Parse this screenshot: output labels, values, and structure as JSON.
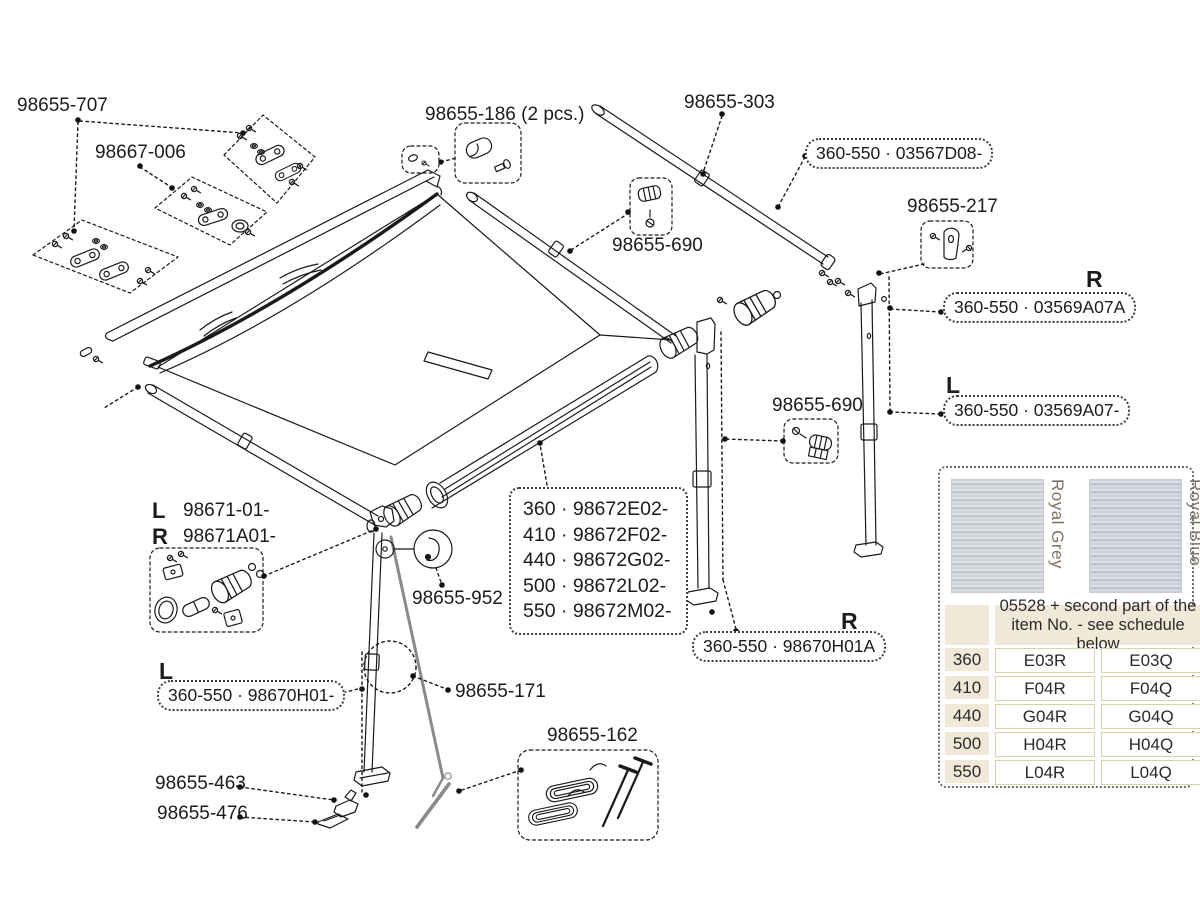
{
  "labels": {
    "p707": "98655-707",
    "p667006": "98667-006",
    "p186": "98655-186 (2 pcs.)",
    "p303": "98655-303",
    "box03567": "360-550 · 03567D08-",
    "p217": "98655-217",
    "p690a": "98655-690",
    "p690b": "98655-690",
    "r1": "R",
    "boxRA": "360-550 · 03569A07A",
    "l1": "L",
    "boxLA": "360-550 · 03569A07-",
    "l671": "L",
    "p671L": "98671-01-",
    "r671": "R",
    "p671R": "98671A01-",
    "p952": "98655-952",
    "sizes": [
      "360 · 98672E02-",
      "410 · 98672F02-",
      "440 · 98672G02-",
      "500 · 98672L02-",
      "550 · 98672M02-"
    ],
    "r2": "R",
    "boxRB": "360-550 · 98670H01A",
    "l2": "L",
    "boxLB": "360-550 · 98670H01-",
    "p171": "98655-171",
    "p463": "98655-463",
    "p476": "98655-476",
    "p162": "98655-162"
  },
  "panel": {
    "swatches": [
      {
        "name": "Royal Grey"
      },
      {
        "name": "Royal Blue"
      }
    ],
    "table": {
      "header": "05528 + second part of the item No. - see schedule below",
      "rows": [
        [
          "360",
          "E03R",
          "E03Q"
        ],
        [
          "410",
          "F04R",
          "F04Q"
        ],
        [
          "440",
          "G04R",
          "G04Q"
        ],
        [
          "500",
          "H04R",
          "H04Q"
        ],
        [
          "550",
          "L04R",
          "L04Q"
        ]
      ]
    }
  },
  "colors": {
    "line": "#1a1a1a",
    "beige": "#f0e9d7",
    "swatch_text": "#7b7265",
    "rope_grey": "#8a8a8a"
  }
}
